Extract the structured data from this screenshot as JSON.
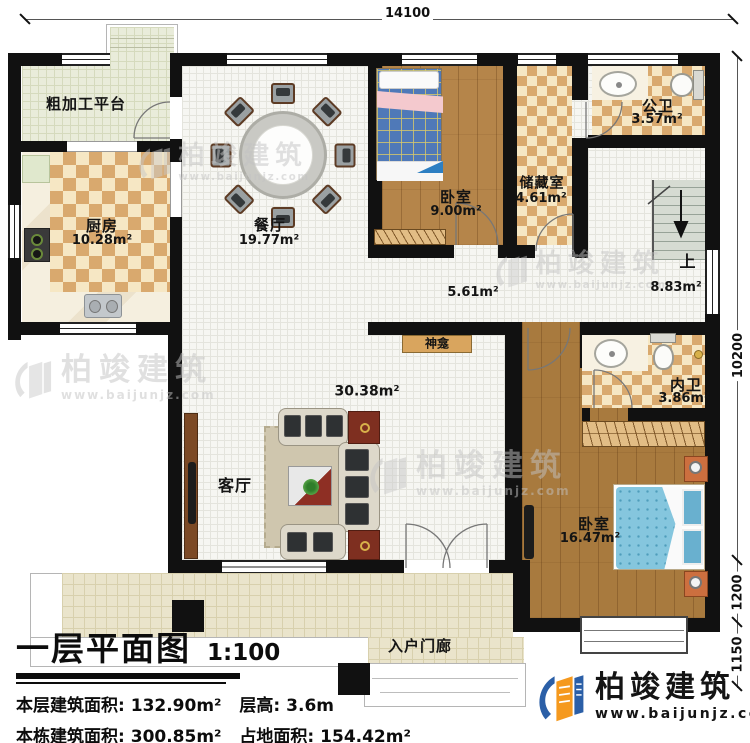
{
  "plan": {
    "dimensions": {
      "top": "14100",
      "right_upper": "10200",
      "right_mid": "1200",
      "right_lower": "1150"
    },
    "rooms": {
      "platform": {
        "label": "粗加工平台"
      },
      "kitchen": {
        "label": "厨房",
        "area": "10.28m²"
      },
      "dining": {
        "label": "餐厅",
        "area": "19.77m²"
      },
      "bedroom_small": {
        "label": "卧室",
        "area": "9.00m²"
      },
      "storage": {
        "label": "储藏室",
        "area": "4.61m²"
      },
      "public_bath": {
        "label": "公卫",
        "area": "3.57m²"
      },
      "stair_up": {
        "label": "上",
        "area": "8.83m²"
      },
      "hallway": {
        "area": "5.61m²"
      },
      "shrine": {
        "label": "神龛"
      },
      "inner_bath": {
        "label": "内卫",
        "area": "3.86m²"
      },
      "living": {
        "label": "客厅",
        "area": "30.38m²"
      },
      "bedroom_master": {
        "label": "卧室",
        "area": "16.47m²"
      },
      "entry_porch": {
        "label": "入户门廊"
      }
    },
    "title_block": {
      "title": "一层平面图",
      "scale": "1:100",
      "floor_area_label": "本层建筑面积:",
      "floor_area_value": "132.90m²",
      "height_label": "层高:",
      "height_value": "3.6m",
      "building_area_label": "本栋建筑面积:",
      "building_area_value": "300.85m²",
      "footprint_label": "占地面积:",
      "footprint_value": "154.42m²"
    },
    "brand": {
      "name": "柏竣建筑",
      "url": "www.baijunjz.com"
    }
  }
}
